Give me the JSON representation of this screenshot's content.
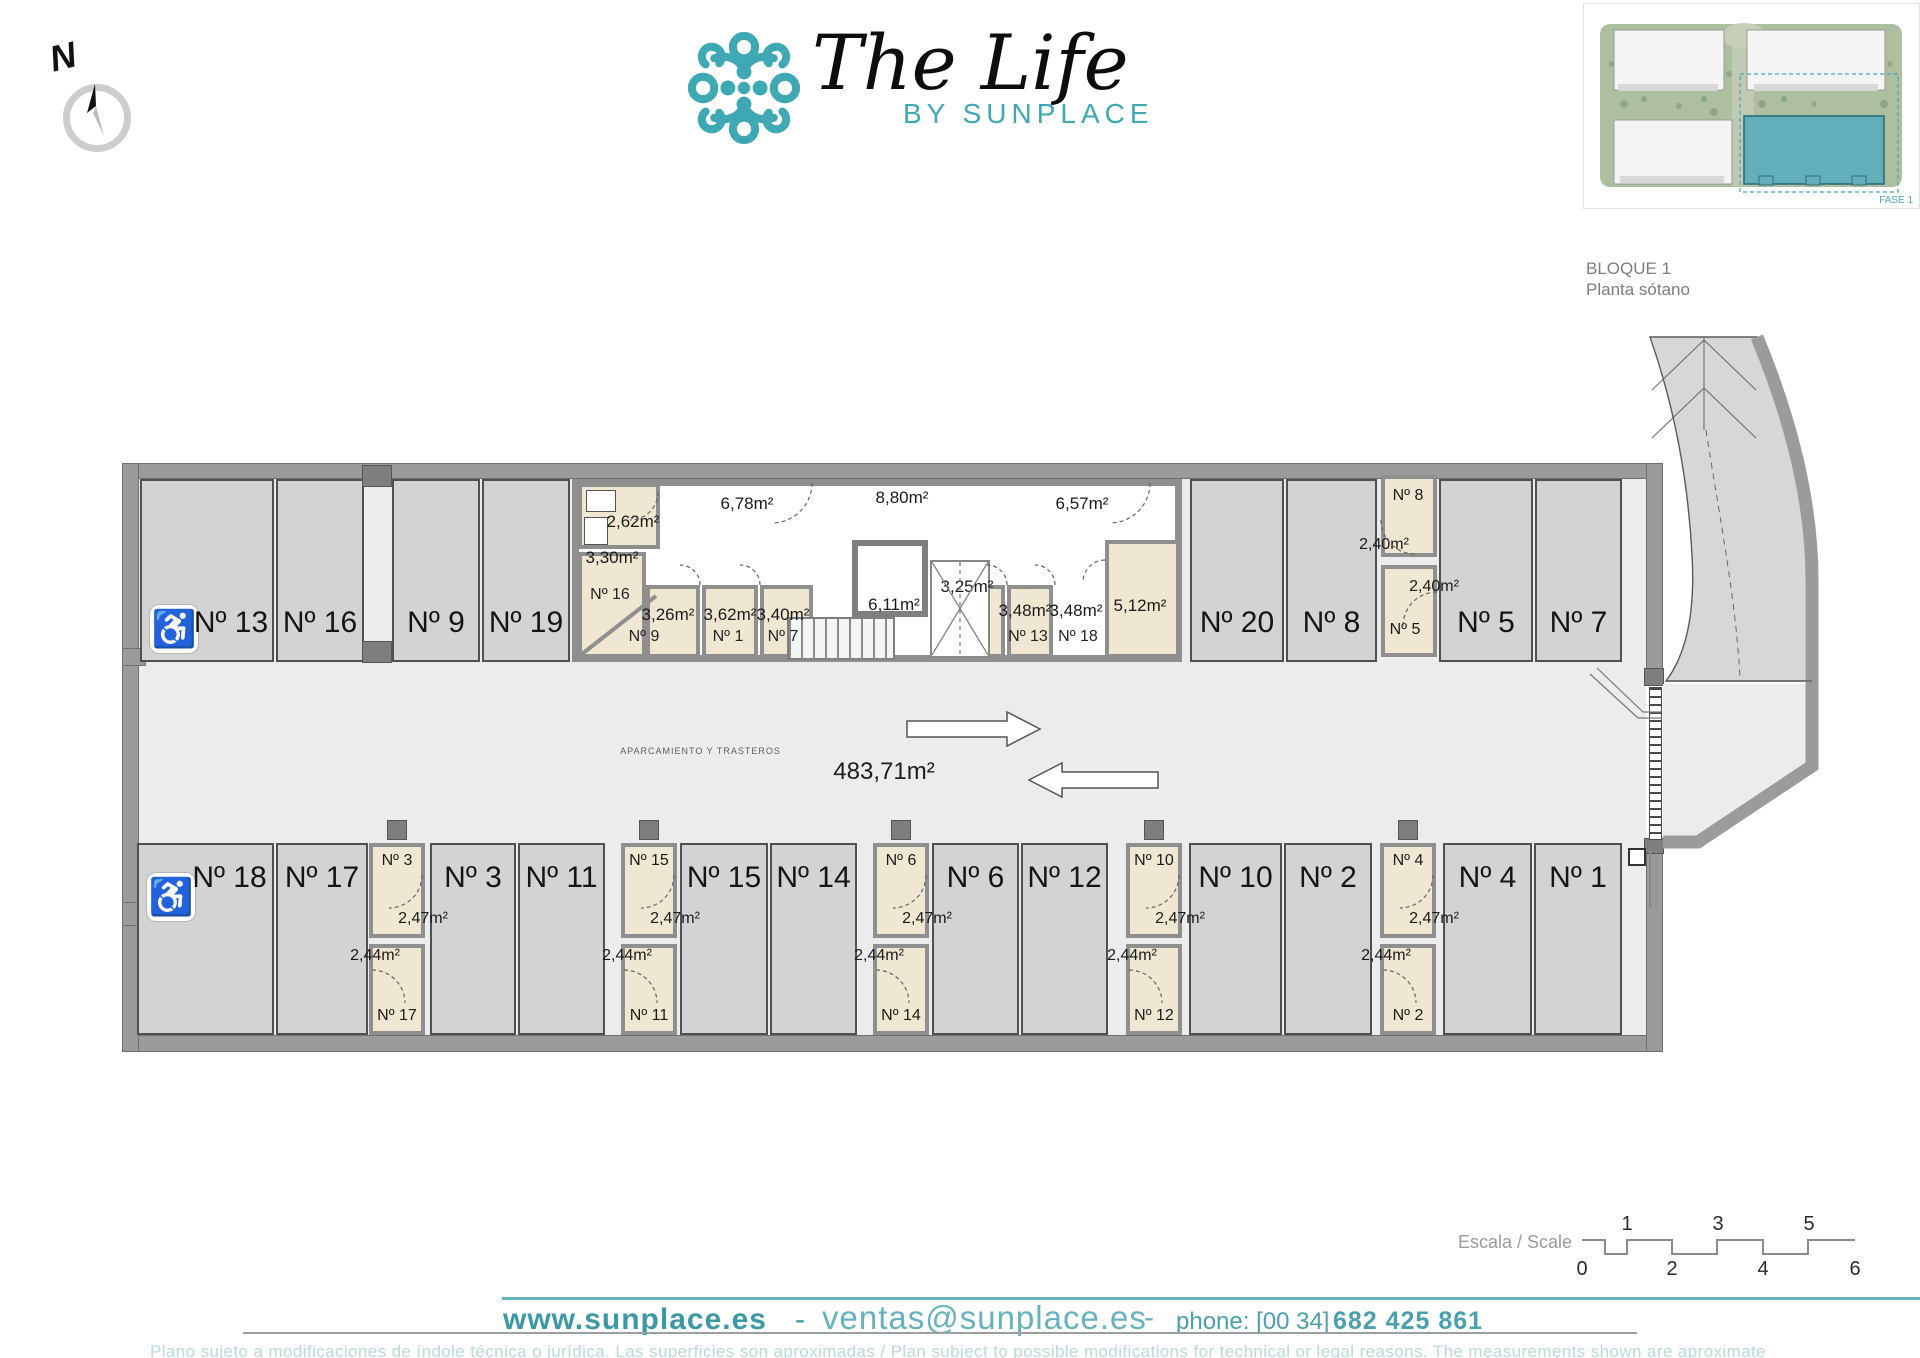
{
  "compass": {
    "north_label": "N"
  },
  "icons": {
    "handicap": "♿"
  },
  "logo": {
    "title": "The Life",
    "subtitle": "BY SUNPLACE",
    "accent_color": "#3fa8b5"
  },
  "block_info": {
    "line1": "BLOQUE 1",
    "line2": "Planta sótano"
  },
  "site_plan": {
    "fase_label": "FASE 1"
  },
  "plan": {
    "central": {
      "name": "APARCAMIENTO Y TRASTEROS",
      "area": "483,71m²"
    },
    "parking_top": [
      {
        "label": "Nº 13",
        "handicap": true
      },
      {
        "label": "Nº 16"
      },
      {
        "label": "Nº 9"
      },
      {
        "label": "Nº 19"
      },
      {
        "label": "Nº 20"
      },
      {
        "label": "Nº 8"
      },
      {
        "label": "Nº 5"
      },
      {
        "label": "Nº 7"
      }
    ],
    "parking_bottom": [
      {
        "label": "Nº 18",
        "handicap": true
      },
      {
        "label": "Nº 17"
      },
      {
        "label": "Nº 3"
      },
      {
        "label": "Nº 11"
      },
      {
        "label": "Nº 15"
      },
      {
        "label": "Nº 14"
      },
      {
        "label": "Nº 6"
      },
      {
        "label": "Nº 12"
      },
      {
        "label": "Nº 10"
      },
      {
        "label": "Nº 2"
      },
      {
        "label": "Nº 4"
      },
      {
        "label": "Nº 1"
      }
    ],
    "top_rooms": {
      "room_262": "2,62m²",
      "corr_678": "6,78m²",
      "corr_880": "8,80m²",
      "corr_657": "6,57m²",
      "room_330": "3,30m²",
      "name_16": "Nº 16",
      "room_326": "3,26m²",
      "name_9": "Nº 9",
      "room_362": "3,62m²",
      "name_1": "Nº 1",
      "room_340": "3,40m²",
      "name_7": "Nº 7",
      "elevator": "6,11m²",
      "corr_325": "3,25m²",
      "room_348a": "3,48m²",
      "name_13": "Nº 13",
      "room_348b": "3,48m²",
      "name_18": "Nº 18",
      "room_512": "5,12m²",
      "col_upper_name": "Nº 8",
      "col_upper_area": "2,40m²",
      "col_lower_area": "2,40m²",
      "col_lower_name": "Nº 5"
    },
    "bottom_cols": [
      {
        "upper_name": "Nº 3",
        "upper_area": "2,47m²",
        "lower_area": "2,44m²",
        "lower_name": "Nº 17"
      },
      {
        "upper_name": "Nº 15",
        "upper_area": "2,47m²",
        "lower_area": "2,44m²",
        "lower_name": "Nº 11"
      },
      {
        "upper_name": "Nº 6",
        "upper_area": "2,47m²",
        "lower_area": "2,44m²",
        "lower_name": "Nº 14"
      },
      {
        "upper_name": "Nº 10",
        "upper_area": "2,47m²",
        "lower_area": "2,44m²",
        "lower_name": "Nº 12"
      },
      {
        "upper_name": "Nº 4",
        "upper_area": "2,47m²",
        "lower_area": "2,44m²",
        "lower_name": "Nº 2"
      }
    ]
  },
  "scale_bar": {
    "label": "Escala / Scale",
    "ticks_top": [
      "1",
      "3",
      "5"
    ],
    "ticks_bottom": [
      "0",
      "2",
      "4",
      "6"
    ]
  },
  "footer": {
    "website": "www.sunplace.es",
    "sep1": "-",
    "email": "ventas@sunplace.es",
    "sep2": "-",
    "phone_prefix": "phone: [00 34]",
    "phone_number": "682 425 861",
    "disclaimer": "Plano sujeto a modificaciones de índole técnica o jurídica. Las superficies son aproximadas / Plan subject to possible modifications for technical or legal reasons. The measurements  shown are aproximate"
  }
}
